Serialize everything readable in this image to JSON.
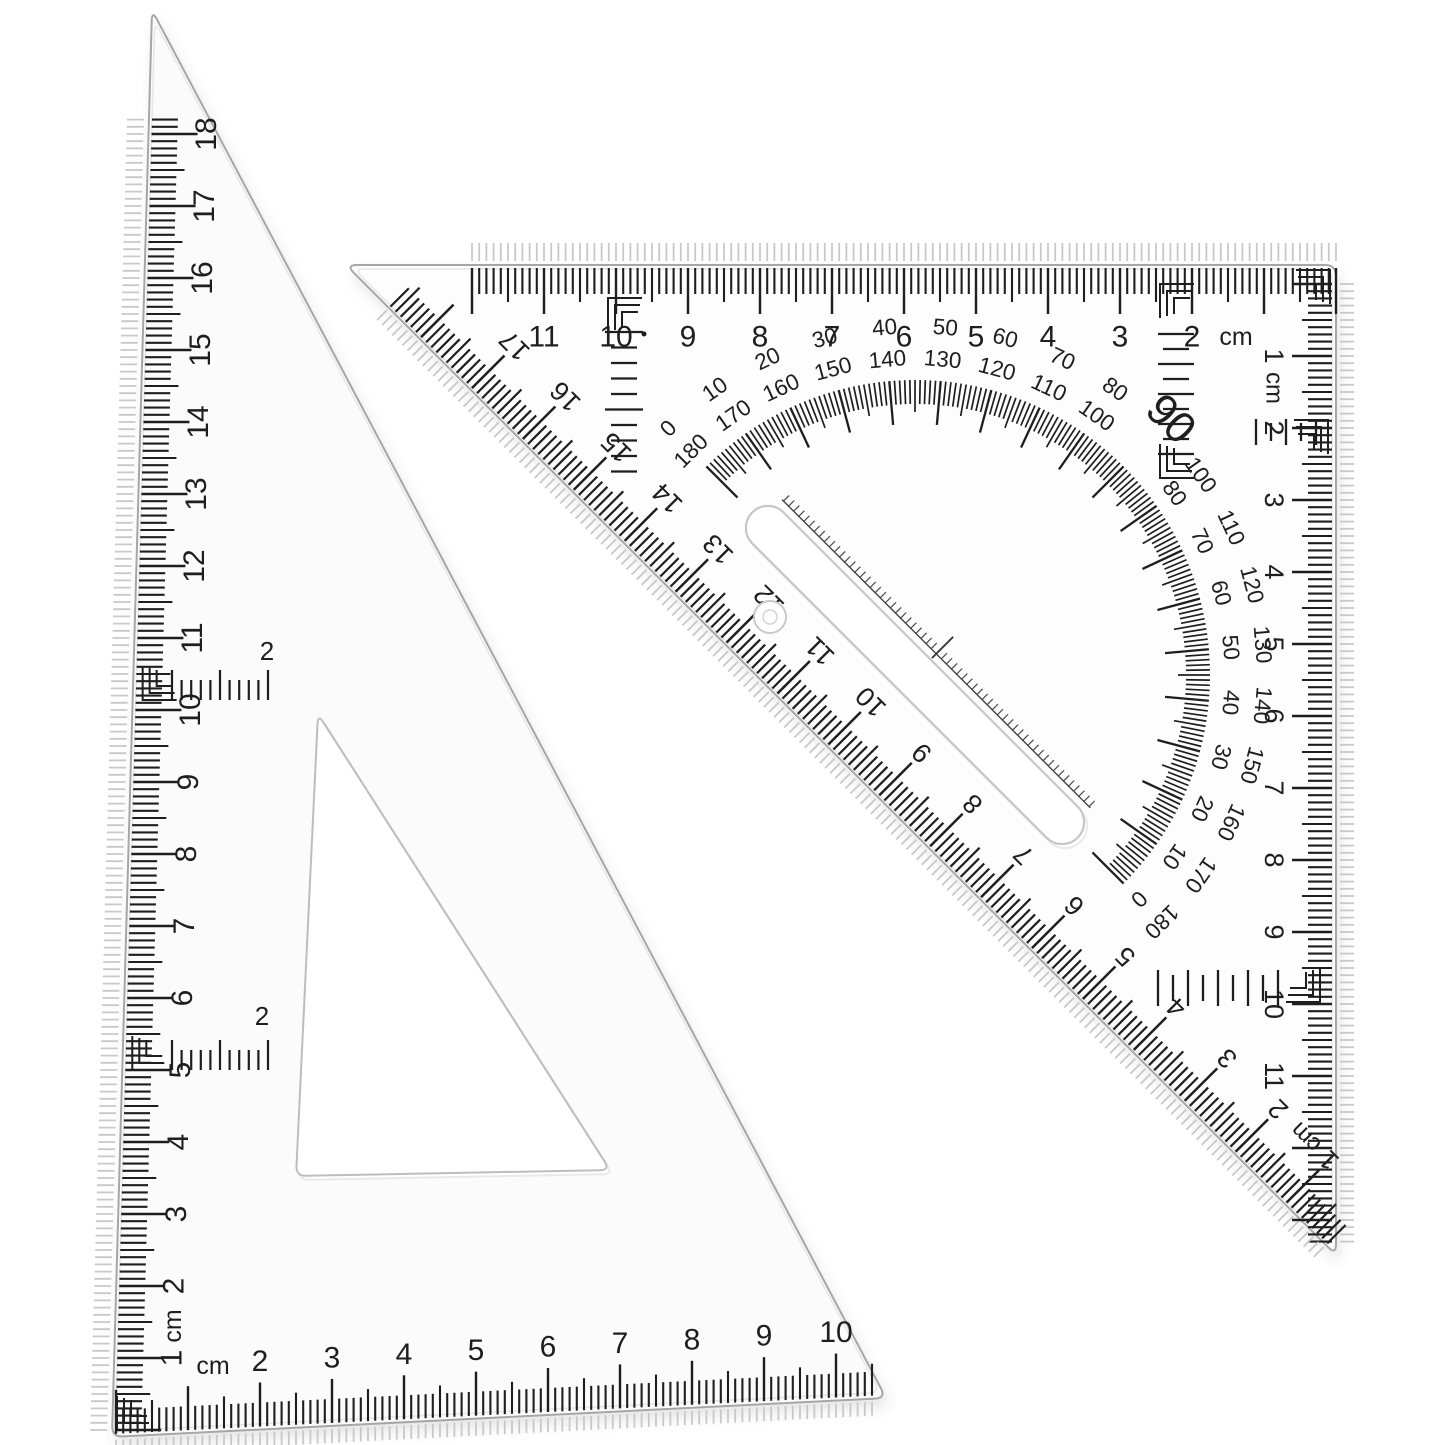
{
  "scene": {
    "description": "Two transparent plastic drafting set squares, one with built-in 180-degree protractor",
    "background": "#ffffff"
  },
  "colors": {
    "ink": "#1e1e1e",
    "ghost": "#c8c8c8",
    "edge": "#a6a6a6",
    "edge_inner": "#e7e7e7",
    "slot_edge": "#c6c6c6",
    "left_body": "#fbfbfb",
    "right_body": "#fdfdfd",
    "baseline": "#3a3a3a"
  },
  "left_triangle": {
    "vertical_scale": {
      "unit": "cm",
      "numbers": [
        "1",
        "2",
        "3",
        "4",
        "5",
        "6",
        "7",
        "8",
        "9",
        "10",
        "11",
        "12",
        "13",
        "14",
        "15",
        "16",
        "17",
        "18"
      ]
    },
    "bottom_scale": {
      "unit": "cm",
      "numbers": [
        "2",
        "3",
        "4",
        "5",
        "6",
        "7",
        "8",
        "9",
        "10"
      ]
    },
    "aux_marks": [
      {
        "label": "2"
      },
      {
        "label": "2"
      }
    ]
  },
  "right_triangle": {
    "top_scale": {
      "unit": "cm",
      "numbers": [
        "2",
        "3",
        "4",
        "5",
        "6",
        "7",
        "8",
        "9",
        "10",
        "11"
      ]
    },
    "right_scale": {
      "first_number": "1",
      "unit": "cm",
      "numbers": [
        "2",
        "3",
        "4",
        "5",
        "6",
        "7",
        "8",
        "9",
        "10",
        "11"
      ]
    },
    "hypotenuse_scale": {
      "first_number": "1",
      "unit": "cm",
      "numbers": [
        "2",
        "3",
        "4",
        "5",
        "6",
        "7",
        "8",
        "9",
        "10",
        "11",
        "12",
        "13",
        "14",
        "15",
        "16",
        "17"
      ]
    },
    "protractor": {
      "ninety": "90",
      "pairs": [
        {
          "outer": "0",
          "inner": "180"
        },
        {
          "outer": "10",
          "inner": "170"
        },
        {
          "outer": "20",
          "inner": "160"
        },
        {
          "outer": "30",
          "inner": "150"
        },
        {
          "outer": "40",
          "inner": "140"
        },
        {
          "outer": "50",
          "inner": "130"
        },
        {
          "outer": "60",
          "inner": "120"
        },
        {
          "outer": "70",
          "inner": "110"
        },
        {
          "outer": "80",
          "inner": "100"
        },
        {
          "outer": "100",
          "inner": "80"
        },
        {
          "outer": "110",
          "inner": "70"
        },
        {
          "outer": "120",
          "inner": "60"
        },
        {
          "outer": "130",
          "inner": "50"
        },
        {
          "outer": "140",
          "inner": "40"
        },
        {
          "outer": "150",
          "inner": "30"
        },
        {
          "outer": "160",
          "inner": "20"
        },
        {
          "outer": "170",
          "inner": "10"
        },
        {
          "outer": "180",
          "inner": "0"
        }
      ]
    }
  }
}
